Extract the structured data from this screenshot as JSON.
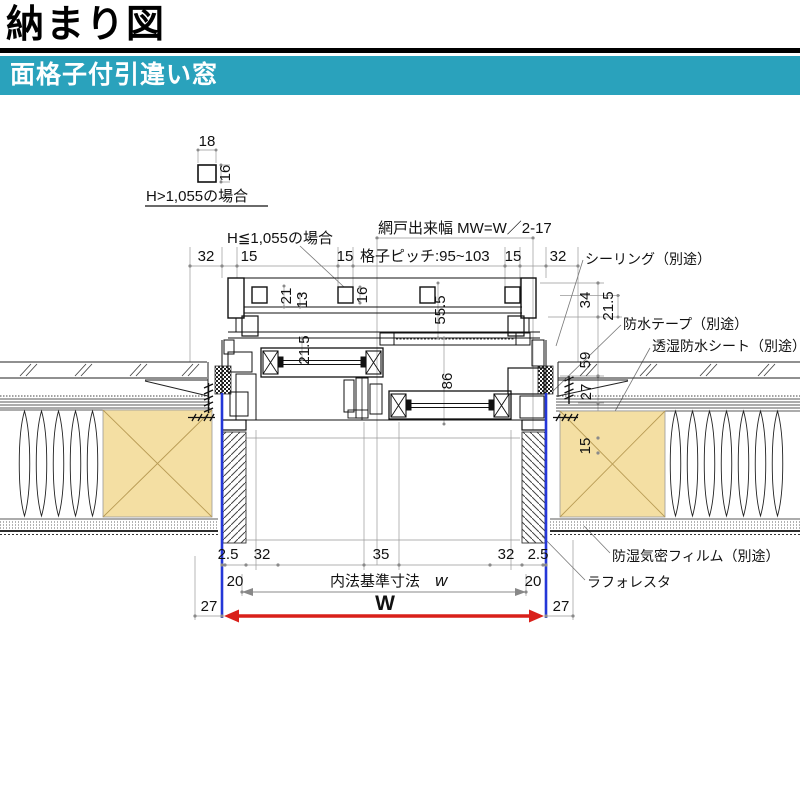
{
  "title": "納まり図",
  "banner": {
    "label": "面格子付引違い窓",
    "color": "#2AA2BC"
  },
  "colors": {
    "banner_teal": "#2AA2BC",
    "frame_blue": "#2437D8",
    "arrow_red": "#D9201A",
    "wood_tan": "#F4DFA3"
  },
  "detail_note": {
    "w": "18",
    "h": "16",
    "caption": "H>1,055の場合"
  },
  "labels": {
    "grille_case": "H≦1,055の場合",
    "mesh_width": "網戸出来幅 MW=W／2-17",
    "pitch": "格子ピッチ:95~103",
    "sealing": "シーリング（別途）",
    "tape": "防水テープ（別途）",
    "sheet": "透湿防水シート（別途）",
    "film": "防湿気密フィルム（別途）",
    "laforesta": "ラフォレスタ",
    "inner_label": "内法基準寸法",
    "inner_var": "w",
    "width_var": "W"
  },
  "dims": {
    "top": {
      "d32l": "32",
      "d15l": "15",
      "d15m": "15",
      "d15r": "15",
      "d32r": "32"
    },
    "grille": {
      "d21": "21",
      "d13": "13",
      "d16": "16",
      "d21_5": "21.5",
      "d55_5": "55.5"
    },
    "frame": {
      "d86": "86"
    },
    "right": {
      "d34": "34",
      "d21_5": "21.5",
      "d59": "59",
      "d27": "27",
      "d15": "15"
    },
    "bottom": {
      "d2_5l": "2.5",
      "d32l": "32",
      "d35": "35",
      "d32r": "32",
      "d2_5r": "2.5",
      "d20l": "20",
      "d20r": "20",
      "d27l": "27",
      "d27r": "27"
    }
  }
}
